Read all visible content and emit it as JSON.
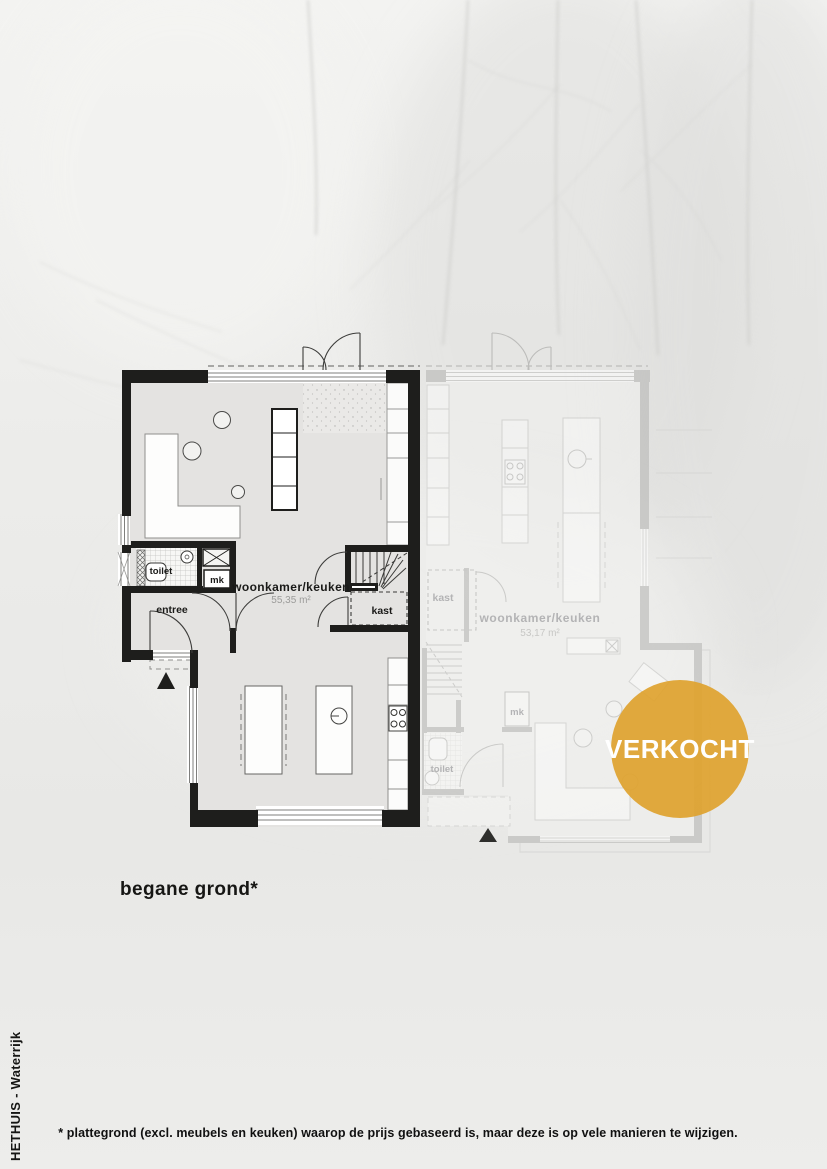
{
  "page": {
    "brand": "HETHUIS - Waterrijk",
    "floor_label": "begane grond*",
    "footnote": "* plattegrond (excl. meubels en keuken) waarop de prijs gebaseerd is, maar deze is op vele manieren te wijzigen."
  },
  "badge": {
    "label": "VERKOCHT",
    "bg": "#DFA32F",
    "fg": "#FFFFFF"
  },
  "plan": {
    "left_unit": {
      "living_label": "woonkamer/keuken",
      "living_area": "55,35 m²",
      "toilet_label": "toilet",
      "mk_label": "mk",
      "entree_label": "entree",
      "kast_label": "kast"
    },
    "right_unit": {
      "living_label": "woonkamer/keuken",
      "living_area": "53,17 m²",
      "toilet_label": "toilet",
      "mk_label": "mk",
      "kast_label": "kast"
    }
  },
  "colors": {
    "wall": "#1E1E1C",
    "floor": "#E4E3E1",
    "faded_wall": "#B3B3B1",
    "badge": "#DFA32F"
  }
}
